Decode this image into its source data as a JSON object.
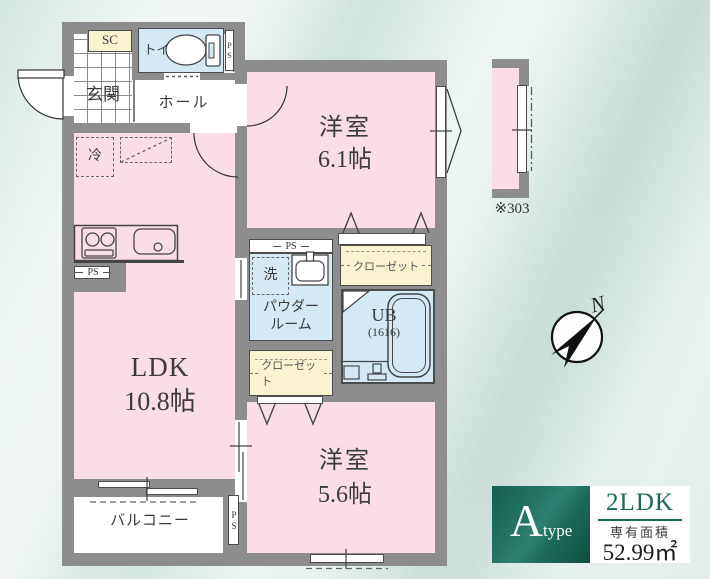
{
  "colors": {
    "wall": "#8d8d8d",
    "room_pink": "#fadde8",
    "wet_blue": "#d4e9f4",
    "closet_yellow": "#f9f3cf",
    "accent_green": "#1b6a58"
  },
  "plan": {
    "entry": {
      "genkan": "玄関",
      "shoe_closet": "SC",
      "toilet": "トイレ",
      "hall": "ホール"
    },
    "rooms": {
      "western1_name": "洋室",
      "western1_size": "6.1帖",
      "ldk_name": "LDK",
      "ldk_size": "10.8帖",
      "western2_name": "洋室",
      "western2_size": "5.6帖",
      "powder_line1": "パウダー",
      "powder_line2": "ルーム",
      "bath_name": "UB",
      "bath_size": "(1616)",
      "closet": "クローゼット",
      "balcony": "バルコニー"
    },
    "fixtures": {
      "refrigerator": "冷",
      "washer": "洗",
      "pipe_space": "PS"
    },
    "note": "※303",
    "compass_north": "N"
  },
  "badge": {
    "type_letter": "A",
    "type_word": "type",
    "layout": "2LDK",
    "area_label": "専有面積",
    "area_value": "52.99㎡"
  }
}
